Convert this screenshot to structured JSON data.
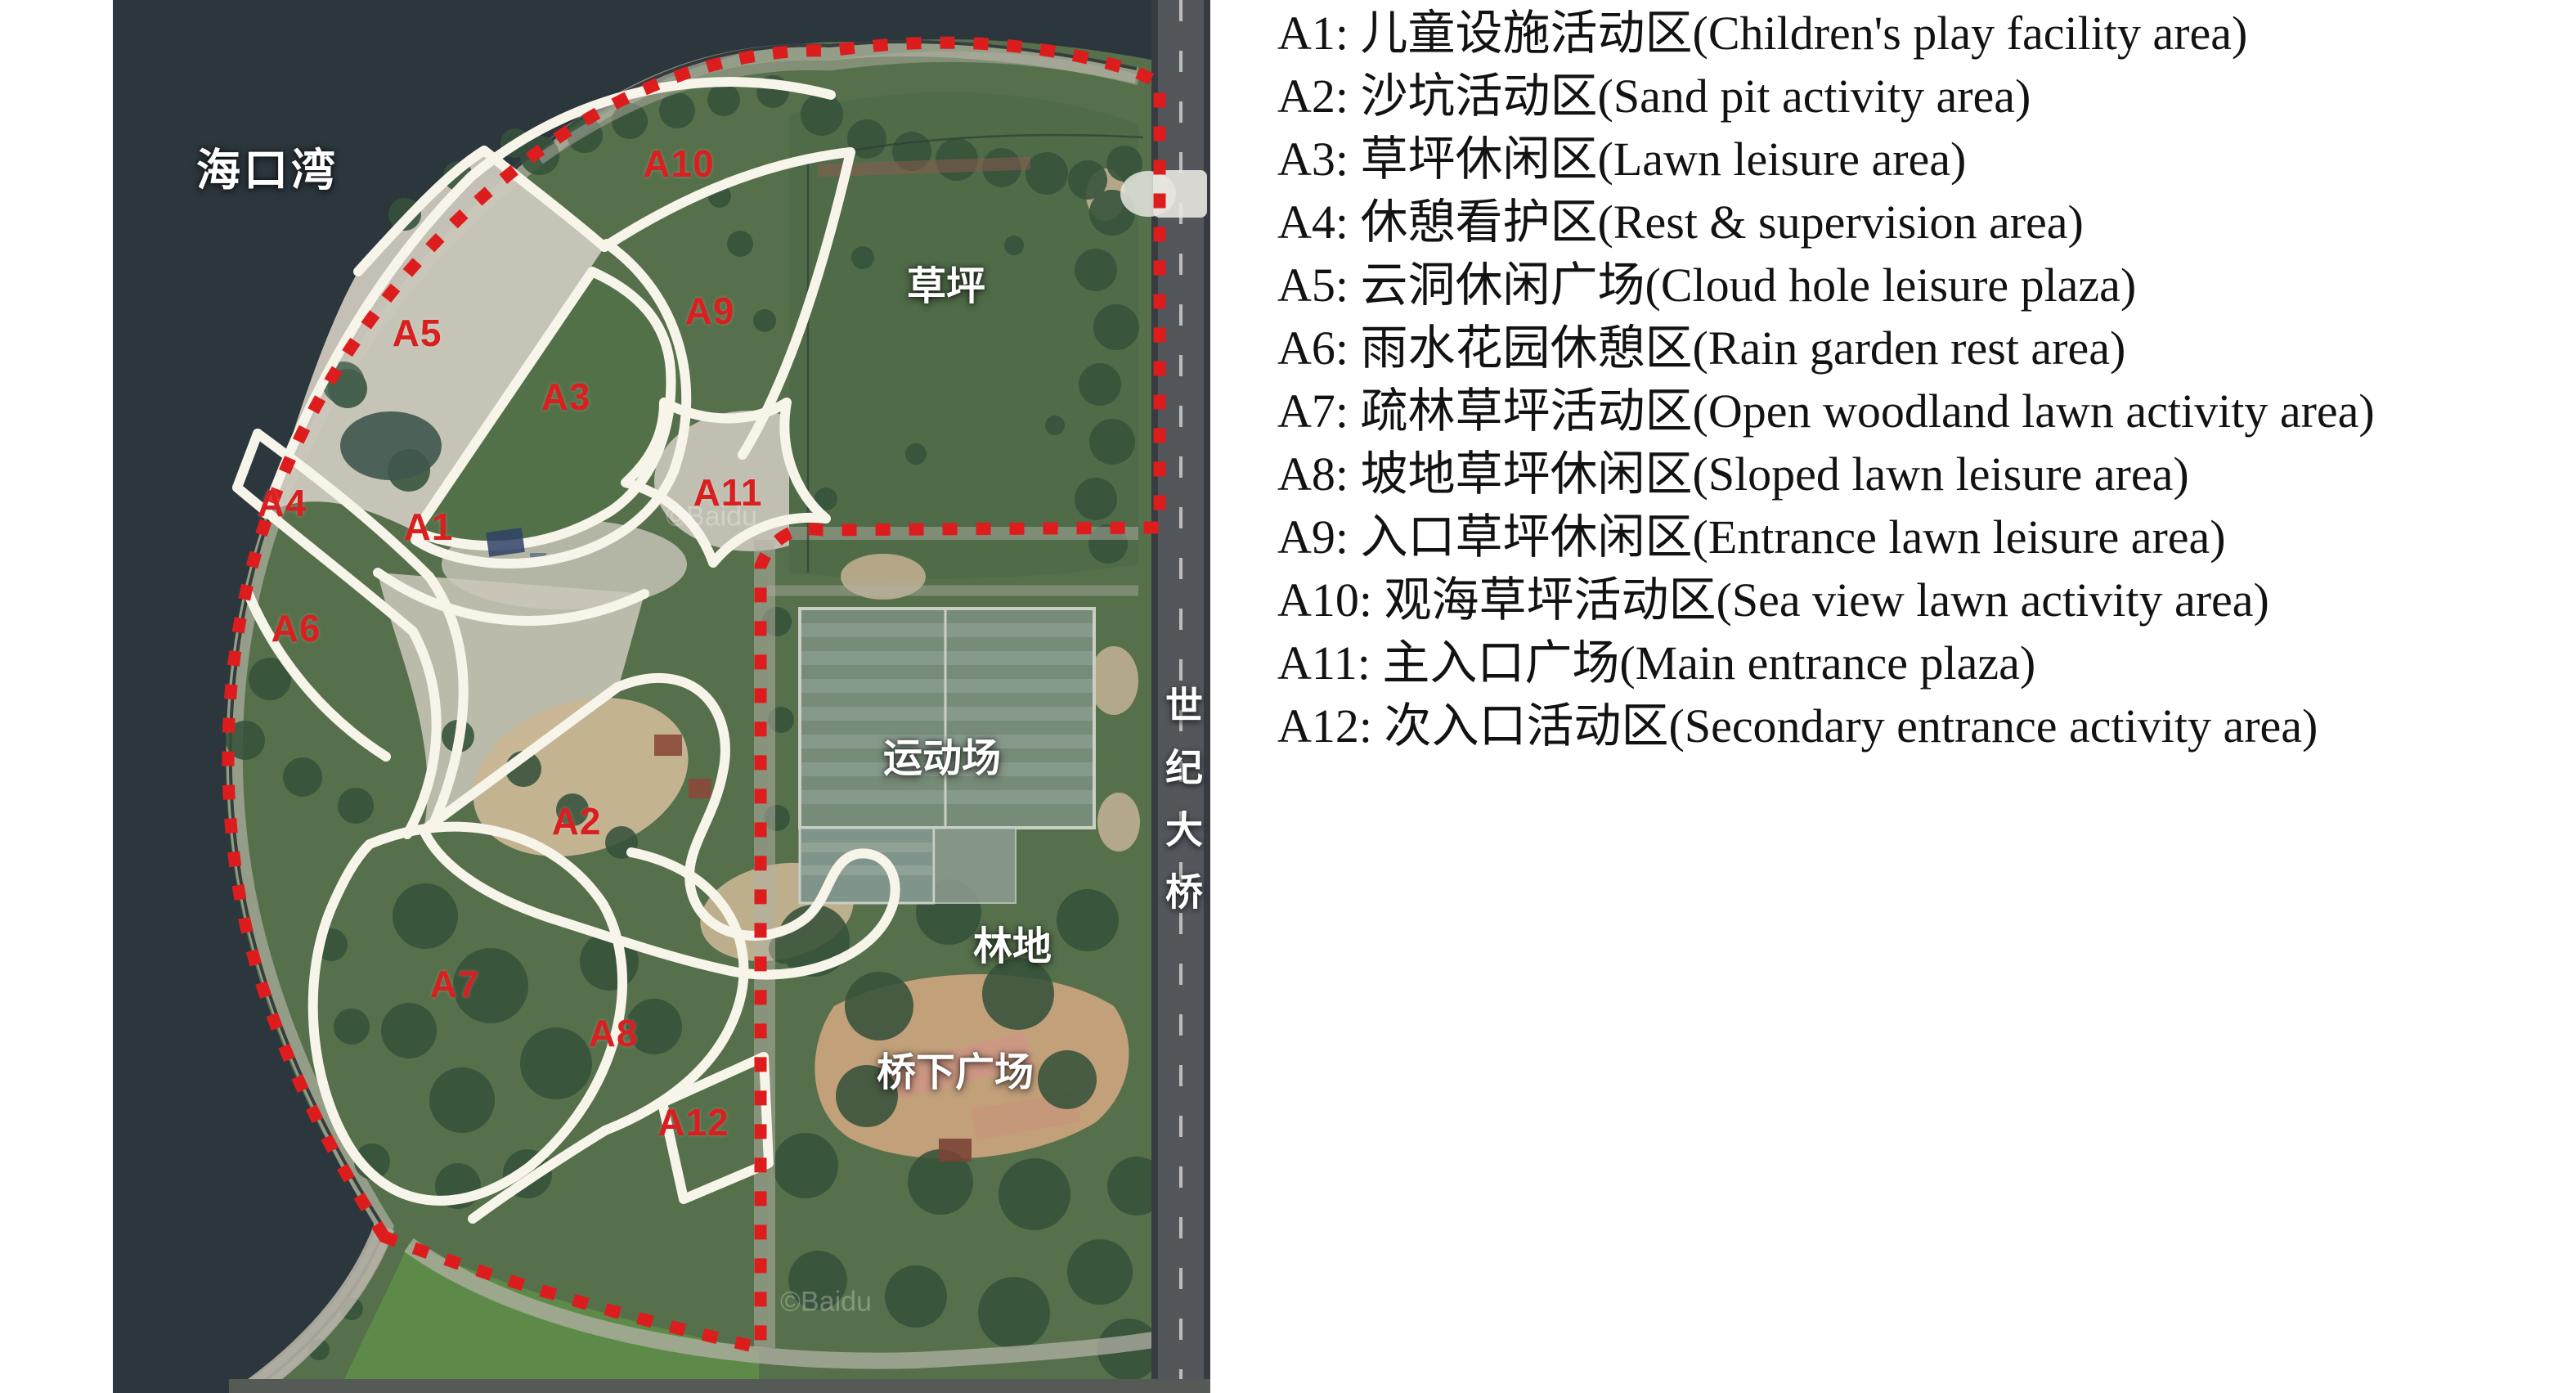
{
  "map": {
    "sea_label": "海口湾",
    "bridge_label": "世纪大桥",
    "watermark": "©Baidu",
    "area_labels": {
      "lawn": "草坪",
      "sports": "运动场",
      "woodland": "林地",
      "under_bridge": "桥下广场"
    },
    "zones": [
      {
        "label": "A1"
      },
      {
        "label": "A2"
      },
      {
        "label": "A3"
      },
      {
        "label": "A4"
      },
      {
        "label": "A5"
      },
      {
        "label": "A6"
      },
      {
        "label": "A7"
      },
      {
        "label": "A8"
      },
      {
        "label": "A9"
      },
      {
        "label": "A10"
      },
      {
        "label": "A11"
      },
      {
        "label": "A12"
      }
    ]
  },
  "legend": {
    "items": [
      {
        "code": "A1",
        "zh": "儿童设施活动区",
        "en": "Children's play facility area",
        "text": "A1: 儿童设施活动区(Children's play facility area)"
      },
      {
        "code": "A2",
        "zh": "沙坑活动区",
        "en": "Sand pit activity area",
        "text": "A2: 沙坑活动区(Sand pit activity area)"
      },
      {
        "code": "A3",
        "zh": "草坪休闲区",
        "en": "Lawn leisure area",
        "text": "A3: 草坪休闲区(Lawn leisure area)"
      },
      {
        "code": "A4",
        "zh": "休憩看护区",
        "en": "Rest & supervision area",
        "text": "A4: 休憩看护区(Rest & supervision area)"
      },
      {
        "code": "A5",
        "zh": "云洞休闲广场",
        "en": "Cloud hole leisure plaza",
        "text": "A5: 云洞休闲广场(Cloud hole leisure plaza)"
      },
      {
        "code": "A6",
        "zh": "雨水花园休憩区",
        "en": "Rain garden rest area",
        "text": "A6: 雨水花园休憩区(Rain garden rest area)"
      },
      {
        "code": "A7",
        "zh": "疏林草坪活动区",
        "en": "Open woodland lawn activity area",
        "text": "A7: 疏林草坪活动区(Open woodland lawn activity area)"
      },
      {
        "code": "A8",
        "zh": "坡地草坪休闲区",
        "en": "Sloped lawn leisure area",
        "text": "A8: 坡地草坪休闲区(Sloped lawn leisure area)"
      },
      {
        "code": "A9",
        "zh": "入口草坪休闲区",
        "en": "Entrance lawn leisure area",
        "text": "A9: 入口草坪休闲区(Entrance lawn leisure area)"
      },
      {
        "code": "A10",
        "zh": "观海草坪活动区",
        "en": "Sea view lawn activity area",
        "text": "A10: 观海草坪活动区(Sea view lawn activity area)"
      },
      {
        "code": "A11",
        "zh": "主入口广场",
        "en": "Main entrance plaza",
        "text": "A11: 主入口广场(Main entrance plaza)"
      },
      {
        "code": "A12",
        "zh": "次入口活动区",
        "en": "Secondary entrance activity area",
        "text": "A12: 次入口活动区(Secondary entrance activity area)"
      }
    ]
  },
  "colors": {
    "sea": "#2c363d",
    "land_green": "#55704b",
    "paved": "#ccc8bc",
    "sand": "#c9b693",
    "zone_outline_white": "#f7f4ea",
    "boundary_red": "#dd1d1d",
    "zone_label_red": "#d92020",
    "bridge_road_gray": "#7e8287",
    "legend_text": "#121212"
  }
}
